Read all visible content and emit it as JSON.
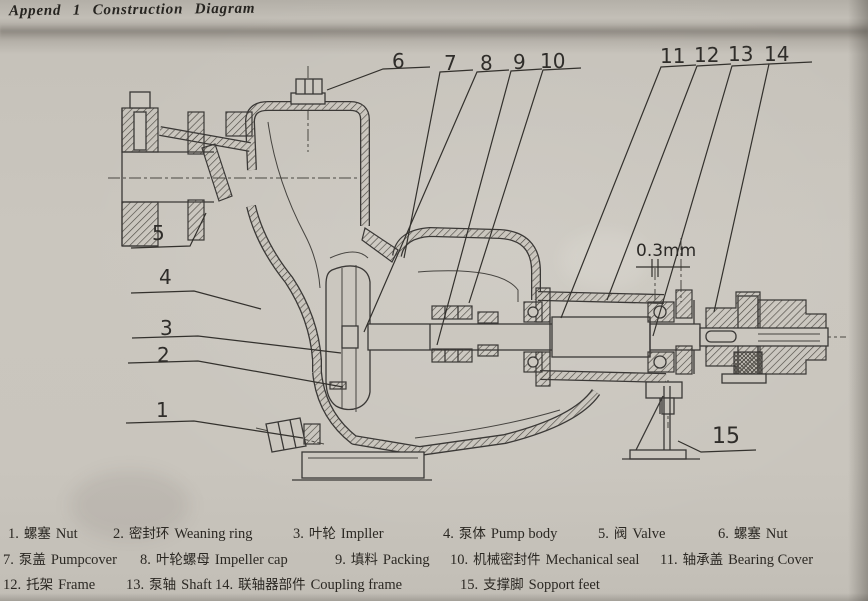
{
  "title": "Append 1 Construction Diagram",
  "dimension": {
    "label": "0.3mm"
  },
  "callouts": {
    "c1": "1",
    "c2": "2",
    "c3": "3",
    "c4": "4",
    "c5": "5",
    "c6": "6",
    "c7": "7",
    "c8": "8",
    "c9": "9",
    "c10": "10",
    "c11": "11",
    "c12": "12",
    "c13": "13",
    "c14": "14",
    "c15": "15"
  },
  "legend": {
    "items": [
      {
        "num": "1.",
        "zh": "螺塞",
        "en": "Nut"
      },
      {
        "num": "2.",
        "zh": "密封环",
        "en": "Weaning ring"
      },
      {
        "num": "3.",
        "zh": "叶轮",
        "en": "Impller"
      },
      {
        "num": "4.",
        "zh": "泵体",
        "en": "Pump body"
      },
      {
        "num": "5.",
        "zh": "阀",
        "en": "Valve"
      },
      {
        "num": "6.",
        "zh": "螺塞",
        "en": "Nut"
      },
      {
        "num": "7.",
        "zh": "泵盖",
        "en": "Pumpcover"
      },
      {
        "num": "8.",
        "zh": "叶轮螺母",
        "en": "Impeller cap"
      },
      {
        "num": "9.",
        "zh": "填料",
        "en": "Packing"
      },
      {
        "num": "10.",
        "zh": "机械密封件",
        "en": "Mechanical seal"
      },
      {
        "num": "11.",
        "zh": "轴承盖",
        "en": "Bearing Cover"
      },
      {
        "num": "12.",
        "zh": "托架",
        "en": "Frame"
      },
      {
        "num": "13.",
        "zh": "泵轴",
        "en": "Shaft"
      },
      {
        "num": "14.",
        "zh": "联轴器部件",
        "en": "Coupling frame"
      },
      {
        "num": "15.",
        "zh": "支撑脚",
        "en": "Sopport feet"
      }
    ]
  }
}
